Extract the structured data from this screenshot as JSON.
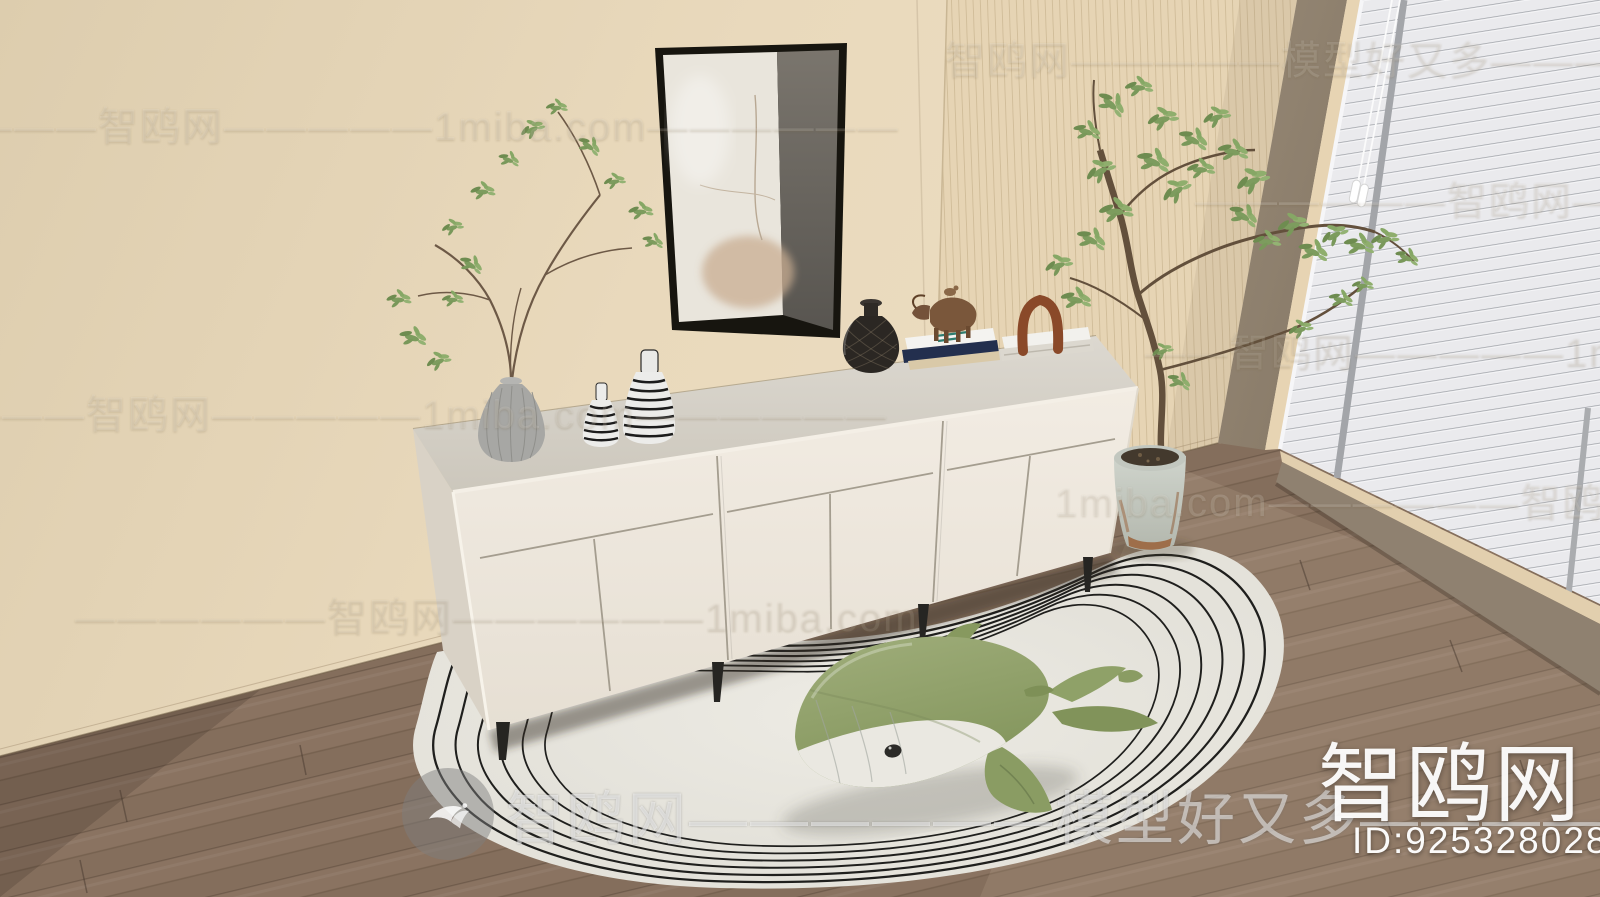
{
  "watermarks": {
    "rows": [
      "智鸥网—————模型好又多——————",
      "————智鸥网—————1miba.com——————",
      "——————智鸥网————",
      "——智鸥网—————1miba.com",
      "———智鸥网—————1miba.com——————",
      "1miba.com——————智鸥网———",
      "——————智鸥网——————1miba.com"
    ],
    "center_text": "智鸥网——————模型好又多————————",
    "brand_name": "智鸥网",
    "model_id": "ID:925328028",
    "site_domain": "1miba.com",
    "slogan": "模型好又多"
  },
  "icons": {
    "bird_logo": "bird-in-circle"
  },
  "colors": {
    "wall": "#e8d8ba",
    "panel_wall": "#e4d2b2",
    "window_frame": "#8d7f6e",
    "blinds": "#e9e9ec",
    "floor": "#8a7361",
    "cabinet_front": "#efe9df",
    "cabinet_top": "#d7d3ca",
    "rug": "#e8e6df",
    "whale_green": "#93a56c",
    "whale_belly": "#eae8e1",
    "foliage": "#7d9c5e",
    "arch_sculpture": "#8a4929",
    "leg_dark": "#262522"
  }
}
